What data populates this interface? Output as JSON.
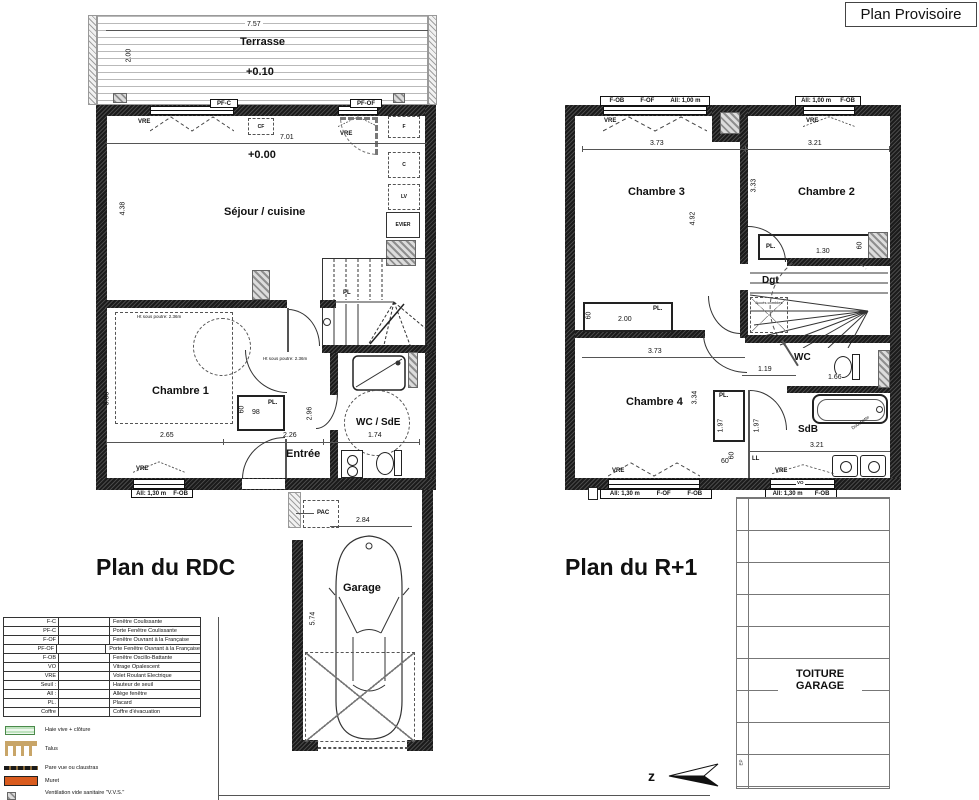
{
  "stamp": "Plan Provisoire",
  "rdc": {
    "title": "Plan du RDC",
    "terrasse": {
      "label": "Terrasse",
      "level": "+0.10",
      "dim_w": "7.57",
      "dim_h": "2.00"
    },
    "top": {
      "pfc": "PF-C",
      "pfof": "PF-OF",
      "vre1": "VRE",
      "vre2": "VRE",
      "cf": "CF"
    },
    "sejour": {
      "label": "Séjour / cuisine",
      "level": "+0.00",
      "dim_w": "7.01",
      "dim_h": "4.38"
    },
    "kitchen": {
      "f": "F",
      "c": "C",
      "lv": "LV",
      "evier": "EVIER"
    },
    "stairs_pl": "PL",
    "notes": {
      "beam1": "Ht sous poutre: 2.36m",
      "beam2": "Ht sous poutre: 2.36m"
    },
    "chambre1": {
      "label": "Chambre 1",
      "dim_w": "2.65",
      "dim_h": "3.88"
    },
    "placard": {
      "label": "PL.",
      "dim_w": "98",
      "dim_d": "60"
    },
    "entree": {
      "label": "Entrée",
      "dim_w": "2.26",
      "dim_h": "2.96"
    },
    "wcsde": {
      "label": "WC / SdE",
      "dim_w": "1.74"
    },
    "win_bottom": {
      "vre": "VRE",
      "allege": "All: 1,30 m",
      "type": "F-OB"
    },
    "pac": "PAC",
    "garage": {
      "label": "Garage",
      "dim_w": "2.84",
      "dim_h": "5.74"
    }
  },
  "r1": {
    "title": "Plan du R+1",
    "win_tl": {
      "a": "F-OB",
      "b": "F-OF",
      "c": "All: 1,00 m",
      "vre": "VRE"
    },
    "win_tr": {
      "a": "All: 1,00 m",
      "b": "F-OB",
      "vre": "VRE"
    },
    "chambre3": {
      "label": "Chambre 3",
      "dim_w": "3.73",
      "dim_h": "4.92",
      "pl": "PL.",
      "pl_w": "2.00",
      "pl_d": "60"
    },
    "chambre2": {
      "label": "Chambre 2",
      "dim_w": "3.21",
      "dim_h": "3.33",
      "pl": "PL.",
      "pl_w": "1.30",
      "pl_d": "60"
    },
    "dgt": {
      "label": "Dgt",
      "acces": "Accès combles"
    },
    "chambre4": {
      "label": "Chambre 4",
      "dim_w": "3.73",
      "dim_h": "3.34"
    },
    "wc": {
      "label": "WC",
      "dim_w": "1.19",
      "dim_d": "1.66"
    },
    "pl_mid": {
      "label": "PL.",
      "d1": "1.97",
      "d2": "1.97",
      "d3": "60"
    },
    "sdb": {
      "label": "SdB",
      "dim_w": "3.21",
      "douchette": "Douchette",
      "ll": "LL"
    },
    "win_bl": {
      "vre": "VRE",
      "a": "All: 1,30 m",
      "b": "F-OF",
      "c": "F-OB"
    },
    "win_br": {
      "vre": "VRE",
      "vo": "VO",
      "a": "All: 1,30 m",
      "b": "F-OB"
    },
    "between_dim": "60",
    "toiture": {
      "line1": "TOITURE",
      "line2": "GARAGE",
      "ep": "EP"
    }
  },
  "legend": {
    "rows": [
      {
        "code": "F-C",
        "desc": "Fenêtre Coulissante"
      },
      {
        "code": "PF-C",
        "desc": "Porte Fenêtre Coulissante"
      },
      {
        "code": "F-OF",
        "desc": "Fenêtre Ouvrant à la Française"
      },
      {
        "code": "PF-OF",
        "desc": "Porte Fenêtre Ouvrant à la Française"
      },
      {
        "code": "F-OB",
        "desc": "Fenêtre Oscillo-Battante"
      },
      {
        "code": "VO",
        "desc": "Vitrage Opalescent"
      },
      {
        "code": "VRE",
        "desc": "Volet Roulant Electrique"
      },
      {
        "code": "Seuil :",
        "desc": "Hauteur de seuil"
      },
      {
        "code": "All :",
        "desc": "Allège fenêtre"
      },
      {
        "code": "PL.",
        "desc": "Placard"
      },
      {
        "code": "Coffre",
        "desc": "Coffre d'évacuation"
      }
    ],
    "symbols": [
      {
        "label": "Haie vive + clôture"
      },
      {
        "label": "Talus"
      },
      {
        "label": "Pare vue ou claustras"
      },
      {
        "label": "Muret"
      },
      {
        "label": "Ventilation vide sanitaire \"V.V.S.\""
      }
    ]
  },
  "compass": "z"
}
